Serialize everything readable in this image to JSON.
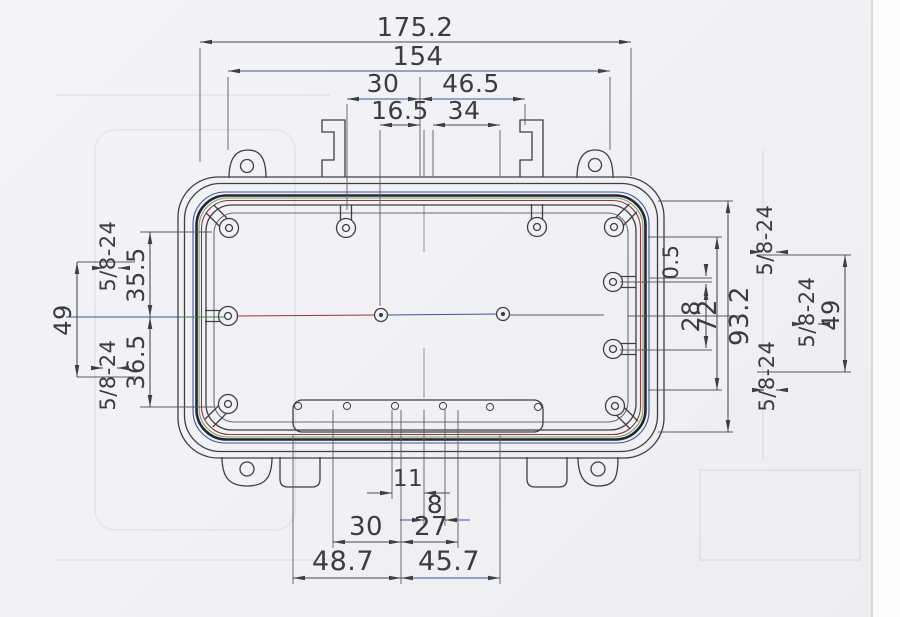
{
  "palette": {
    "line": "#3e3e44",
    "blue": "#3f51a5",
    "red": "#8f3b3b",
    "green": "#3e7d4a",
    "paper": "#f1f1f4"
  },
  "drawing": {
    "type": "enclosure-top-view-dimension-drawing",
    "dims": {
      "top_overall": "175.2",
      "top_flange": "154",
      "top_30": "30",
      "top_46_5": "46.5",
      "top_16_5": "16.5",
      "top_34": "34",
      "left_thread_upper": "5/8-24",
      "left_49": "49",
      "left_35_5": "35.5",
      "left_36_5": "36.5",
      "left_thread_lower": "5/8-24",
      "right_0_5": "0.5",
      "right_28": "28",
      "right_72": "72",
      "right_93_2": "93.2",
      "right_thread_upper": "5/8-24",
      "right_thread_lower": "5/8-24",
      "right_thread_outer": "5/8-24",
      "right_49": "49",
      "bottom_11": "11",
      "bottom_8": "8",
      "bottom_30": "30",
      "bottom_27": "27",
      "bottom_48_7": "48.7",
      "bottom_45_7": "45.7"
    }
  }
}
